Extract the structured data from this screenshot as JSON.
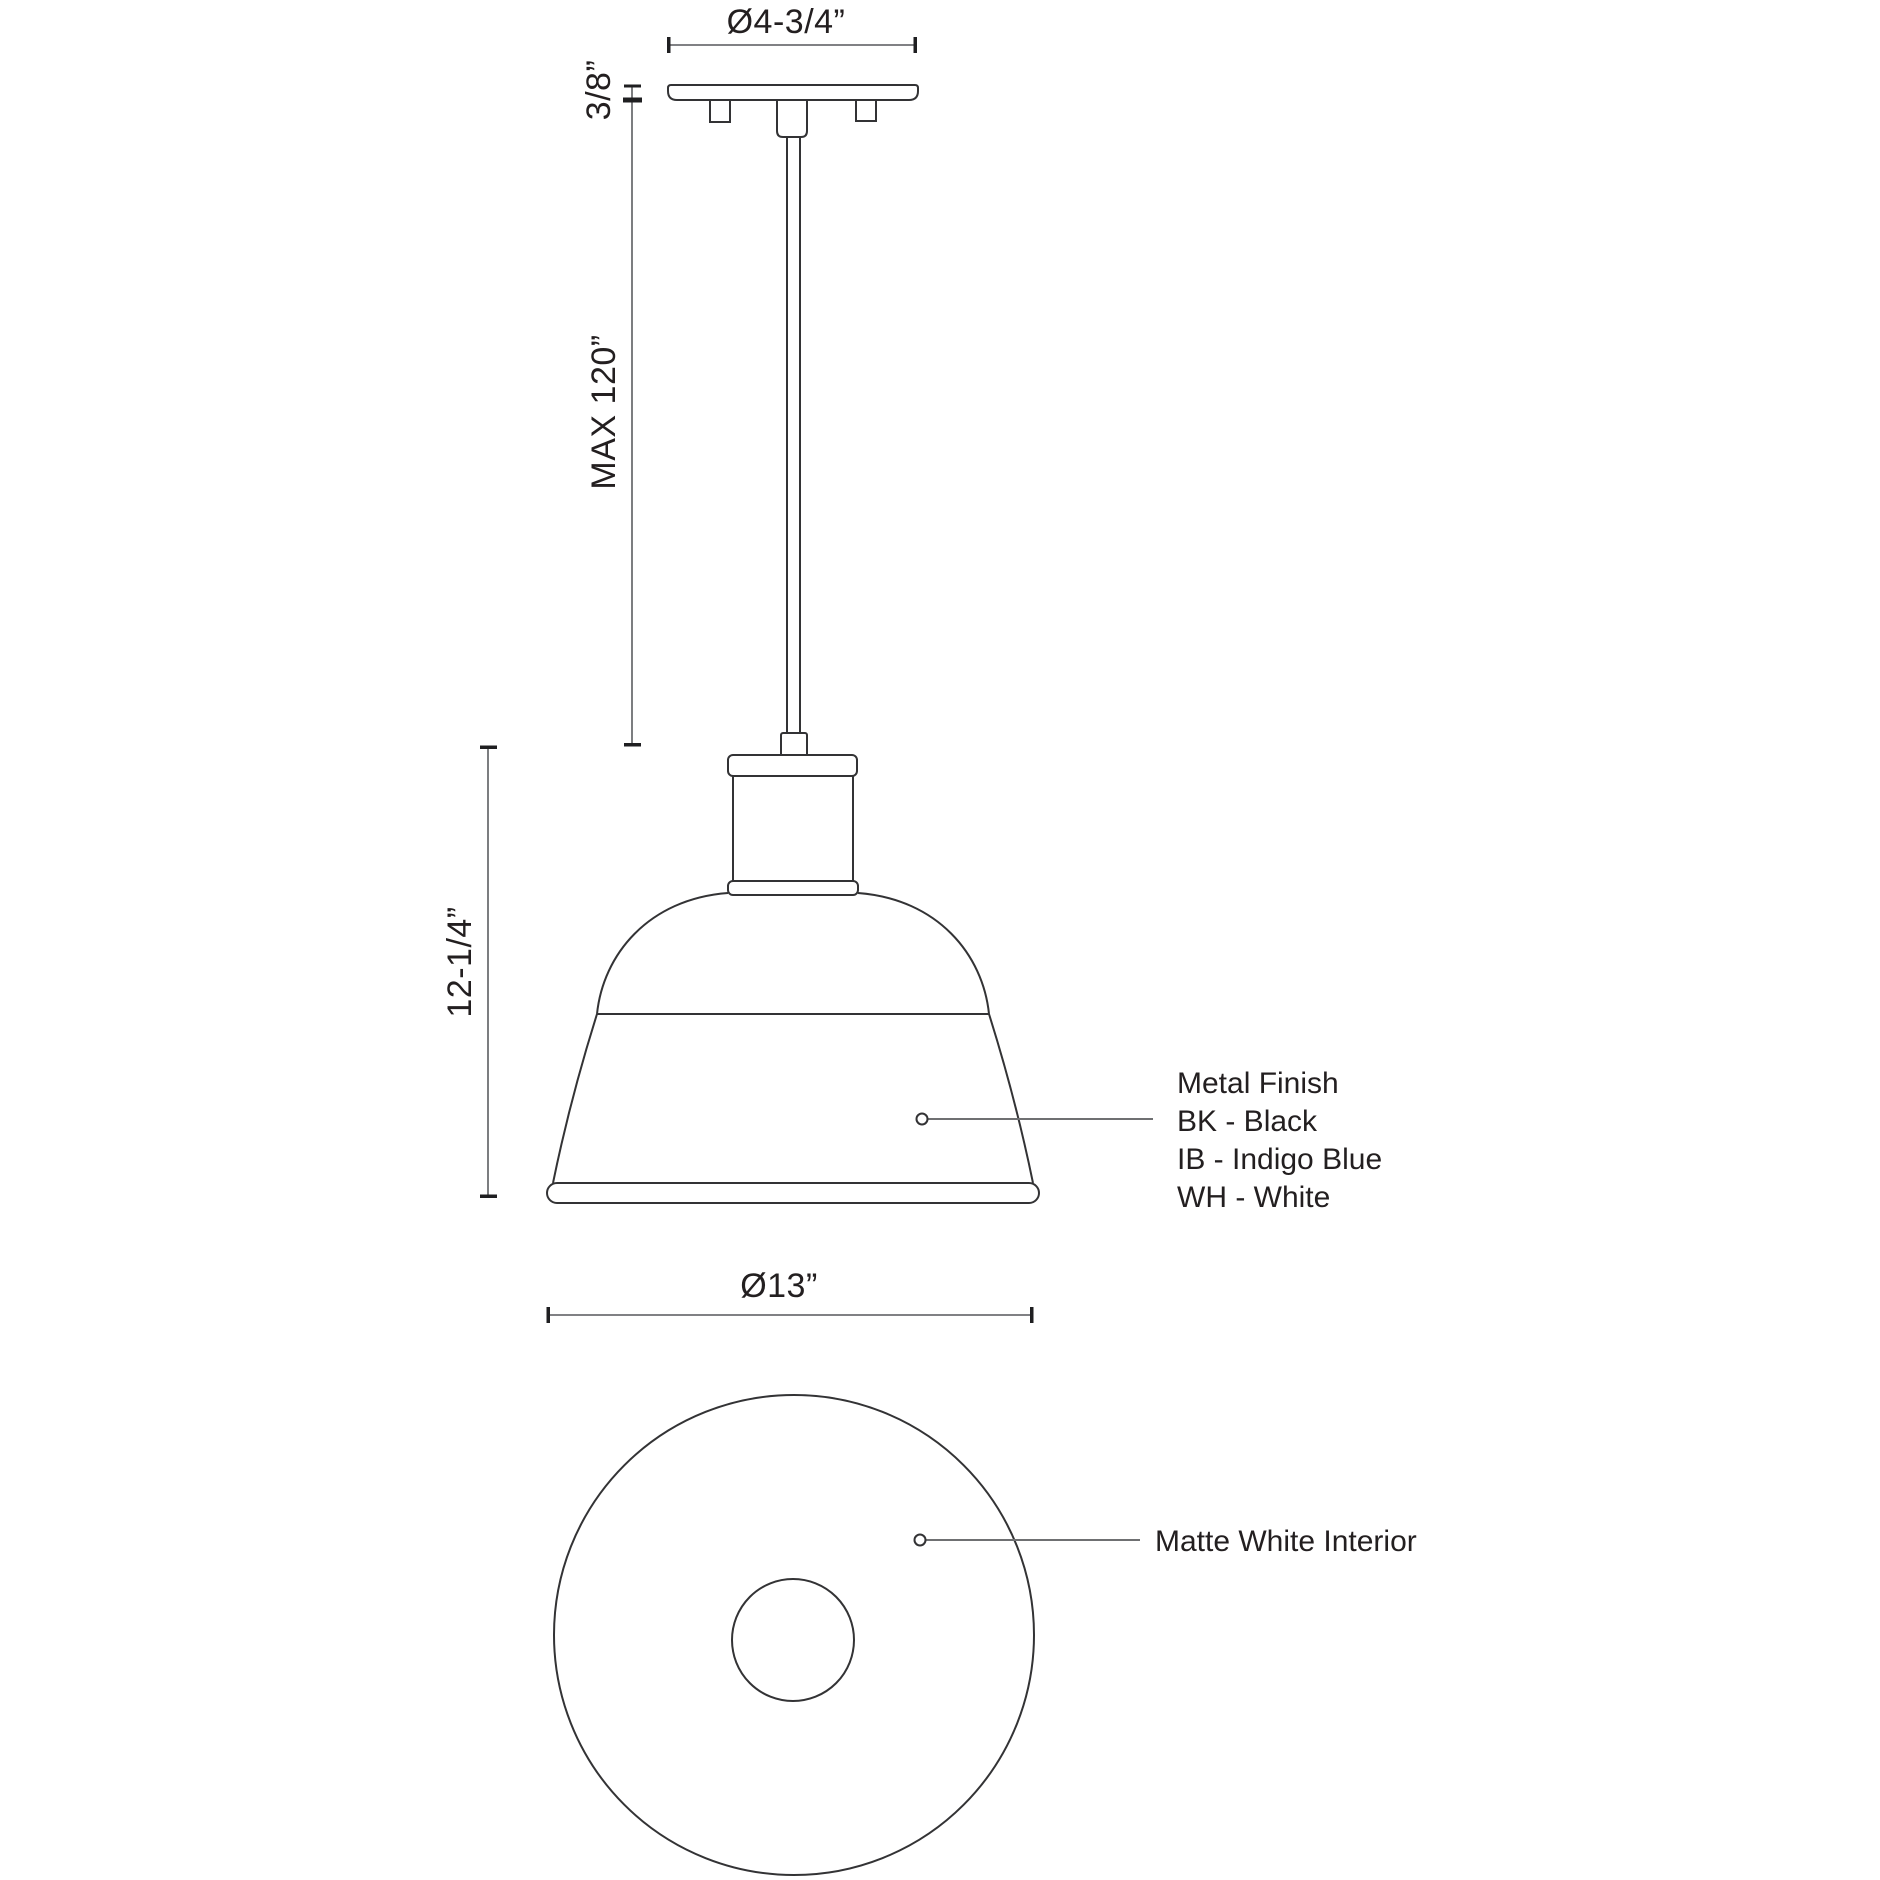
{
  "drawing": {
    "title": "Pendant light fixture specification drawing",
    "dimensions": {
      "canopy_diameter": "Ø4-3/4”",
      "canopy_thickness": "3/8”",
      "stem_max_length": "MAX 120”",
      "fixture_height": "12-1/4”",
      "shade_diameter": "Ø13”"
    },
    "finish_note": {
      "title": "Metal Finish",
      "options": [
        "BK - Black",
        "IB - Indigo Blue",
        "WH - White"
      ]
    },
    "interior_note": "Matte White Interior",
    "colors": {
      "object_line": "#333335",
      "dimension_line": "#6e6f72",
      "tick": "#1f1f21",
      "text": "#231f20",
      "background": "#ffffff"
    }
  }
}
